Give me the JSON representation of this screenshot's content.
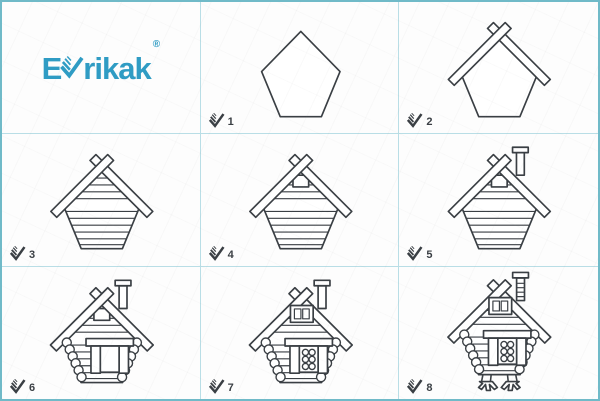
{
  "brand": {
    "name_prefix": "E",
    "name_suffix": "rikak",
    "registered": "®",
    "v_icon": "checkmark-v-icon"
  },
  "colors": {
    "bg": "#fdfdfd",
    "border": "#70bac8",
    "grid": "#b9dee6",
    "ink": "#3a3f44",
    "accent": "#2f9cc4"
  },
  "badge": {
    "icon": "check-icon"
  },
  "steps": [
    {
      "label": "1",
      "dy": 0,
      "parts": [
        "pentagon"
      ]
    },
    {
      "label": "2",
      "dy": 0,
      "parts": [
        "pentagon",
        "roof-beam-right",
        "roof-beam-left"
      ]
    },
    {
      "label": "3",
      "dy": 0,
      "parts": [
        "pentagon",
        "gable-lines",
        "body-lines",
        "roof-beam-right",
        "roof-beam-left"
      ]
    },
    {
      "label": "4",
      "dy": 0,
      "parts": [
        "pentagon",
        "gable-lines",
        "body-lines",
        "attic-window",
        "roof-beam-right",
        "roof-beam-left"
      ]
    },
    {
      "label": "5",
      "dy": 0,
      "parts": [
        "pentagon",
        "gable-lines",
        "body-lines",
        "attic-window",
        "chimney",
        "roof-beam-right",
        "roof-beam-left"
      ]
    },
    {
      "label": "6",
      "dy": 0,
      "parts": [
        "pentagon",
        "gable-lines",
        "body-lines",
        "attic-window",
        "chimney",
        "roof-beam-right",
        "roof-beam-left",
        "side-log-ends",
        "door-window"
      ]
    },
    {
      "label": "7",
      "dy": 0,
      "parts": [
        "pentagon",
        "gable-lines",
        "body-lines",
        "chimney",
        "roof-beam-right",
        "roof-beam-left",
        "side-log-ends",
        "door-window",
        "window-circles",
        "attic-window-paned"
      ]
    },
    {
      "label": "8",
      "dy": -8,
      "parts": [
        "chicken-legs",
        "pentagon",
        "gable-lines",
        "body-lines",
        "chimney-bricks",
        "roof-beam-right",
        "roof-beam-left",
        "side-log-ends",
        "door-window",
        "window-circles",
        "attic-window-paned"
      ]
    }
  ]
}
